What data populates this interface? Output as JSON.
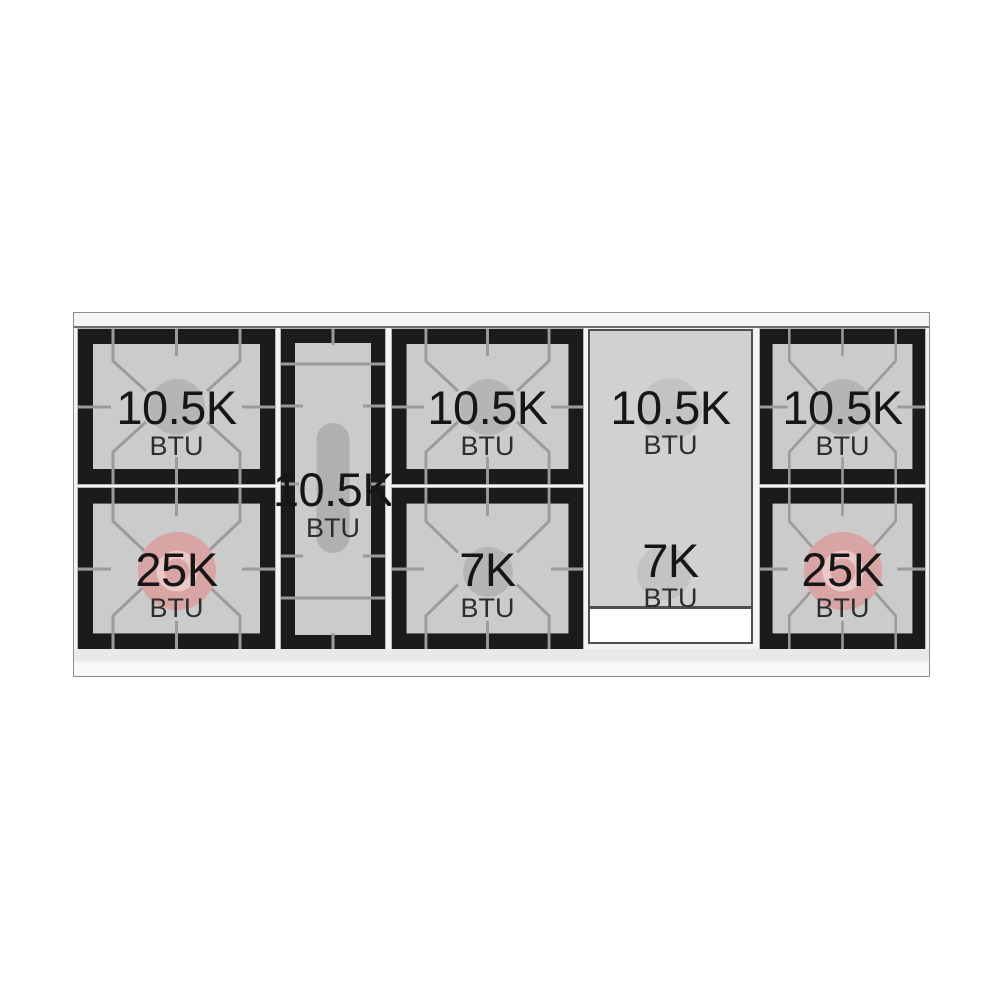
{
  "colors": {
    "grate_black": "#1b1b1b",
    "grate_interior": "#cbcbcb",
    "burner_gray": "#b5b5b5",
    "burner_high_power_pink": "#d9a4a4",
    "griddle_gray": "#d1d1d1"
  },
  "sections": [
    {
      "position": "left-burner-stack",
      "burners": [
        {
          "power": "10.5K",
          "unit": "BTU"
        },
        {
          "power": "25K",
          "unit": "BTU"
        }
      ]
    },
    {
      "position": "center-left-oval-burner",
      "burners": [
        {
          "power": "10.5K",
          "unit": "BTU"
        }
      ]
    },
    {
      "position": "center-burner-stack",
      "burners": [
        {
          "power": "10.5K",
          "unit": "BTU"
        },
        {
          "power": "7K",
          "unit": "BTU"
        }
      ]
    },
    {
      "position": "griddle-panel",
      "burners": [
        {
          "power": "10.5K",
          "unit": "BTU"
        },
        {
          "power": "7K",
          "unit": "BTU"
        }
      ]
    },
    {
      "position": "right-burner-stack",
      "burners": [
        {
          "power": "10.5K",
          "unit": "BTU"
        },
        {
          "power": "25K",
          "unit": "BTU"
        }
      ]
    }
  ]
}
